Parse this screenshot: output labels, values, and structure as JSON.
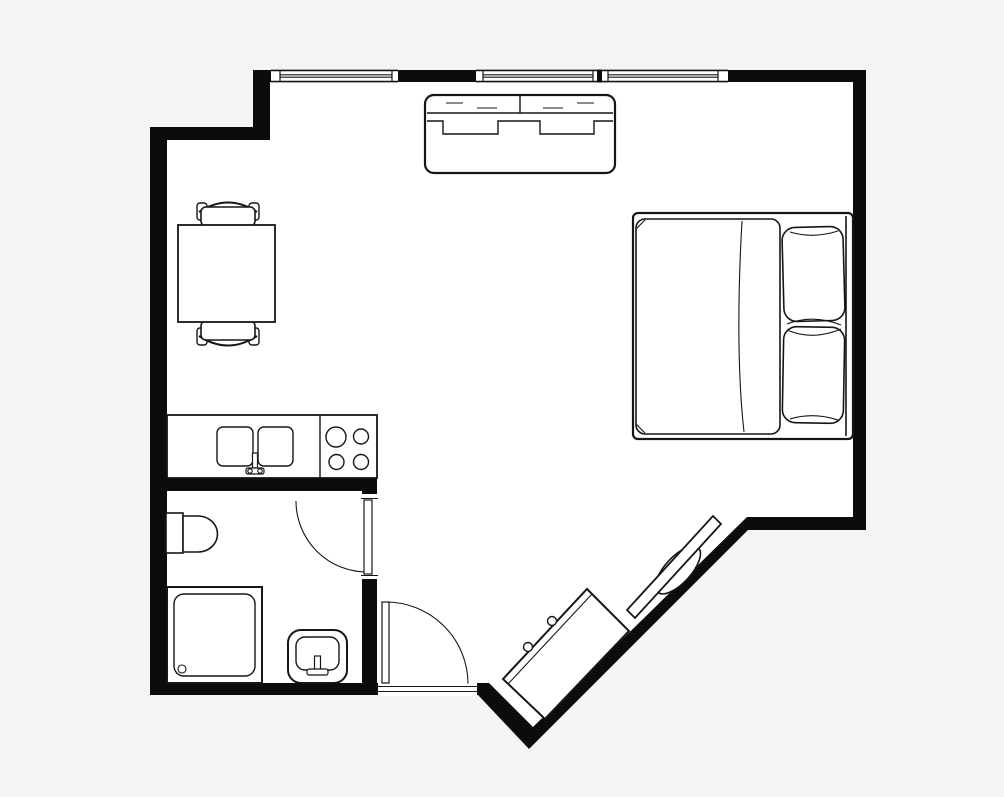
{
  "meta": {
    "title": "Studio apartment floor plan",
    "description": "Black-and-white architectural floor plan, top-down view, no text labels"
  },
  "colors": {
    "background": "#f5f4f2",
    "floor": "#ffffff",
    "wall": "#0c0c0c",
    "ink": "#161616"
  },
  "plan": {
    "rooms": [
      {
        "id": "main-room",
        "label": "Living / sleeping area"
      },
      {
        "id": "kitchenette",
        "label": "Kitchenette along left wall"
      },
      {
        "id": "bathroom",
        "label": "Bathroom, lower left"
      }
    ],
    "windows": [
      {
        "id": "window-left",
        "wall": "top"
      },
      {
        "id": "window-center",
        "wall": "top"
      },
      {
        "id": "window-right",
        "wall": "top"
      }
    ],
    "doors": [
      {
        "id": "entry-door",
        "wall": "bottom",
        "swing": "inward, hinged left"
      },
      {
        "id": "bathroom-door",
        "wall": "bathroom east wall",
        "swing": "into bathroom, hinged top"
      }
    ],
    "furniture": [
      {
        "id": "sofa",
        "label": "Two-seat sofa",
        "room": "main-room"
      },
      {
        "id": "double-bed",
        "label": "Double bed with duvet and two pillows, headboard on right wall",
        "room": "main-room"
      },
      {
        "id": "dining-table",
        "label": "Square dining table",
        "room": "main-room"
      },
      {
        "id": "dining-chair-north",
        "label": "Dining chair (top)",
        "room": "main-room"
      },
      {
        "id": "dining-chair-south",
        "label": "Dining chair (bottom)",
        "room": "main-room"
      },
      {
        "id": "kitchen-counter",
        "label": "Counter with double sink and 4-burner hob",
        "room": "kitchenette"
      },
      {
        "id": "toilet",
        "label": "Toilet",
        "room": "bathroom"
      },
      {
        "id": "shower",
        "label": "Square shower enclosure with drain",
        "room": "bathroom"
      },
      {
        "id": "washbasin",
        "label": "Washbasin",
        "room": "bathroom"
      },
      {
        "id": "sideboard",
        "label": "Angled sideboard against diagonal wall",
        "room": "main-room"
      },
      {
        "id": "tv",
        "label": "TV on stand mounted on diagonal wall",
        "room": "main-room"
      }
    ]
  }
}
